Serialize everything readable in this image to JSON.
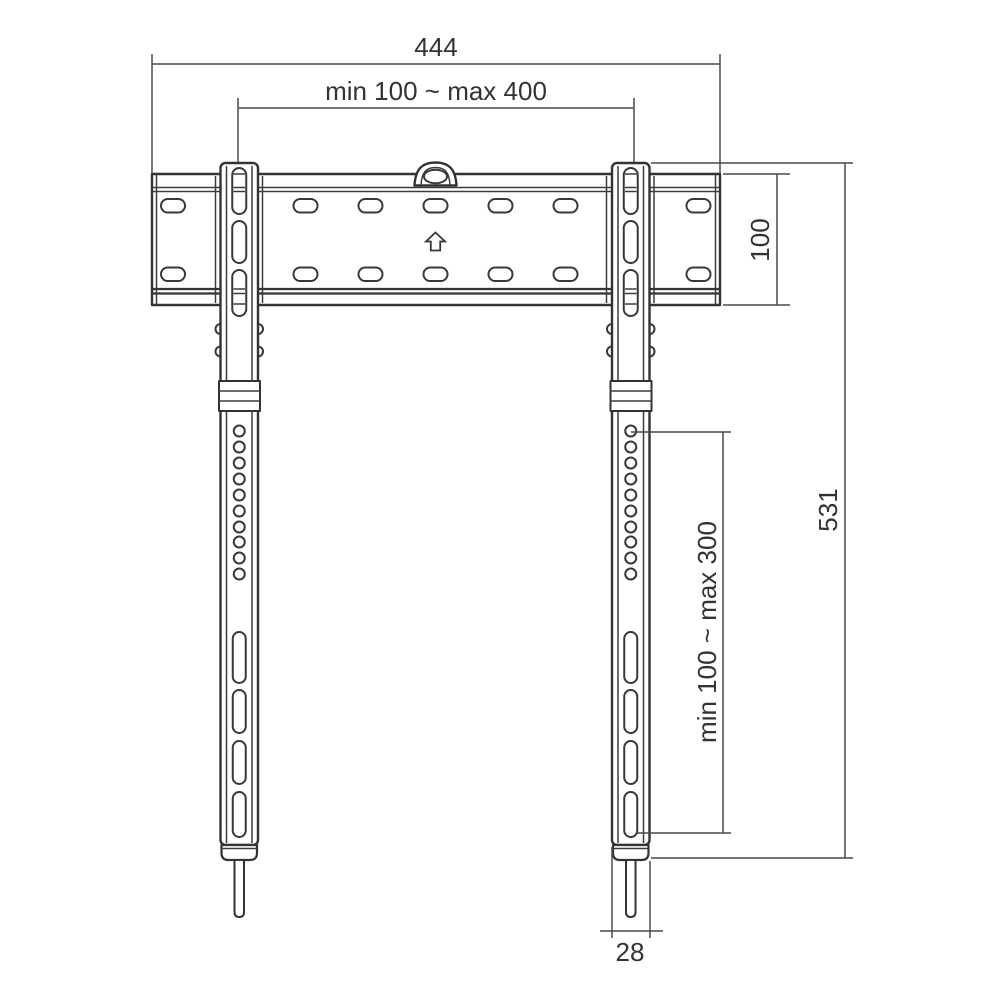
{
  "diagram": {
    "type": "technical-drawing",
    "subject": "fixed TV wall mount bracket, front view with dimensions",
    "background_color": "#ffffff",
    "line_color": "#333333",
    "dimension_line_color": "#4a4a4a",
    "text_color": "#333333",
    "dimensions": {
      "overall_width": "444",
      "horizontal_mount_range": "min 100 ~ max 400",
      "wall_plate_height": "100",
      "overall_height": "531",
      "vertical_mount_range": "min 100 ~ max 300",
      "rail_width": "28"
    },
    "icons": {
      "orientation_arrow": "hollow-up-arrow",
      "hanging_hook": "dome-with-oval-hole"
    }
  }
}
